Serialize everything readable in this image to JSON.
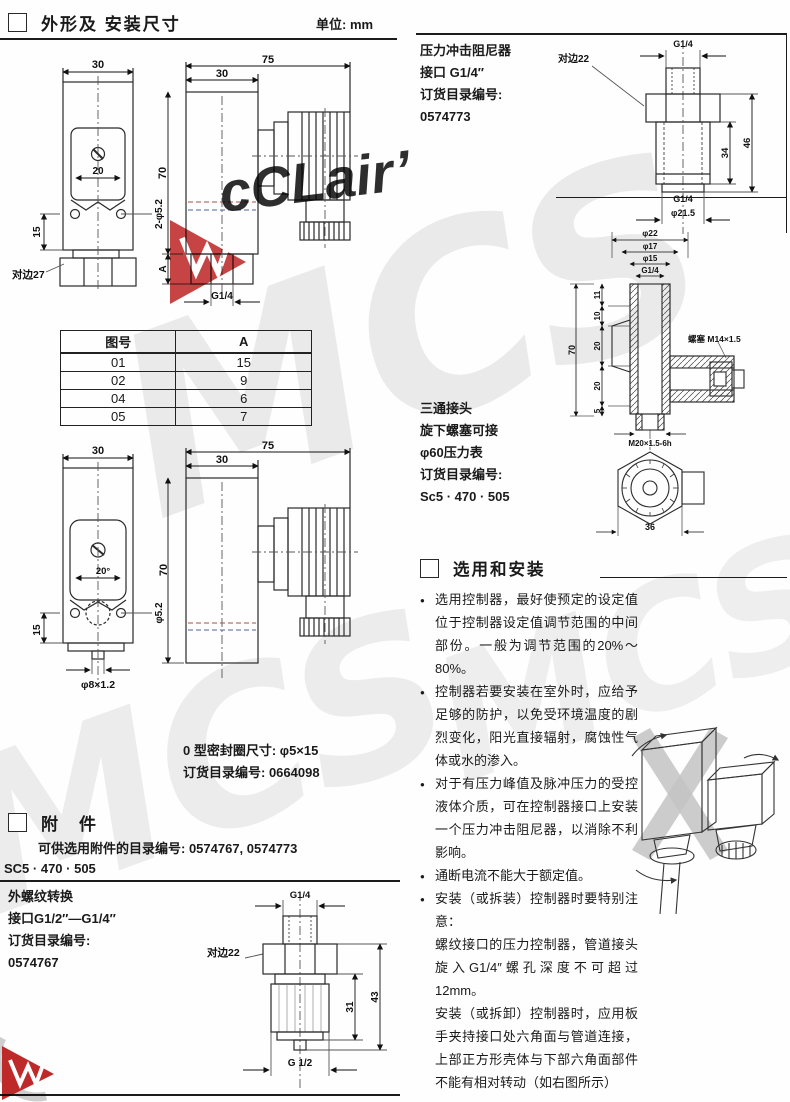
{
  "header": {
    "title": "外形及 安装尺寸",
    "unit": "单位: mm"
  },
  "watermark": {
    "brand": "cCLair’",
    "gray": "MCS"
  },
  "drawing1": {
    "d30a": "30",
    "d20": "20",
    "holes": "2-φ5.2",
    "d15": "15",
    "hex27": "对边27",
    "d75": "75",
    "d30b": "30",
    "d70": "70",
    "dA": "A",
    "g14": "G1/4"
  },
  "table": {
    "col1": "图号",
    "col2": "A",
    "rows": [
      [
        "01",
        "15"
      ],
      [
        "02",
        "9"
      ],
      [
        "04",
        "6"
      ],
      [
        "05",
        "7"
      ]
    ]
  },
  "drawing2": {
    "d30a": "30",
    "angle": "20°",
    "hole": "φ5.2",
    "d15": "15",
    "spigot": "φ8×1.2",
    "d75": "75",
    "d30b": "30",
    "d70": "70"
  },
  "oring": {
    "line1": "0 型密封圈尺寸: φ5×15",
    "line2": "订货目录编号: 0664098"
  },
  "accessories": {
    "title": "附　件",
    "line1": "可供选用附件的目录编号: 0574767, 0574773",
    "line2": "SC5 · 470 · 505"
  },
  "adapter": {
    "line1": "外螺纹转换",
    "line2": "接口G1/2″—G1/4″",
    "line3": "订货目录编号:",
    "line4": "0574767"
  },
  "drawing3": {
    "g14": "G1/4",
    "hex22": "对边22",
    "d31": "31",
    "d43": "43",
    "g12": "G 1/2"
  },
  "damper": {
    "line1": "压力冲击阻尼器",
    "line2": "接口 G1/4″",
    "line3": "订货目录编号:",
    "line4": "0574773"
  },
  "drawing4": {
    "hex22": "对边22",
    "g14top": "G1/4",
    "d34": "34",
    "d46": "46",
    "g14bot": "G1/4",
    "d215": "φ21.5"
  },
  "tee": {
    "line1": "三通接头",
    "line2": "旋下螺塞可接",
    "line3": "φ60压力表",
    "line4": "订货目录编号:",
    "line5": "Sc5 · 470 · 505"
  },
  "drawing5": {
    "d22": "φ22",
    "d17": "φ17",
    "d15": "φ15",
    "g14": "G1/4",
    "d70": "70",
    "d11": "11",
    "d10": "10",
    "d20a": "20",
    "d20b": "20",
    "d5": "5",
    "plug": "螺塞 M14×1.5",
    "thread": "M20×1.5-6h",
    "d36": "36"
  },
  "install": {
    "title": "选用和安装",
    "bullets": [
      "选用控制器，最好使预定的设定值位于控制器设定值调节范围的中间部份。一般为调节范围的20%～80%。",
      "控制器若要安装在室外时，应给予足够的防护，以免受环境温度的剧烈变化，阳光直接辐射，腐蚀性气体或水的渗入。",
      "对于有压力峰值及脉冲压力的受控液体介质，可在控制器接口上安装一个压力冲击阻尼器，以消除不利影响。",
      "通断电流不能大于额定值。",
      "安装（或拆装）控制器时要特别注意："
    ],
    "notes": [
      "螺纹接口的压力控制器，管道接头旋入G1/4″螺孔深度不可超过12mm。",
      "安装（或拆卸）控制器时，应用板手夹持接口处六角面与管道连接，上部正方形壳体与下部六角面部件不能有相对转动（如右图所示）"
    ]
  }
}
